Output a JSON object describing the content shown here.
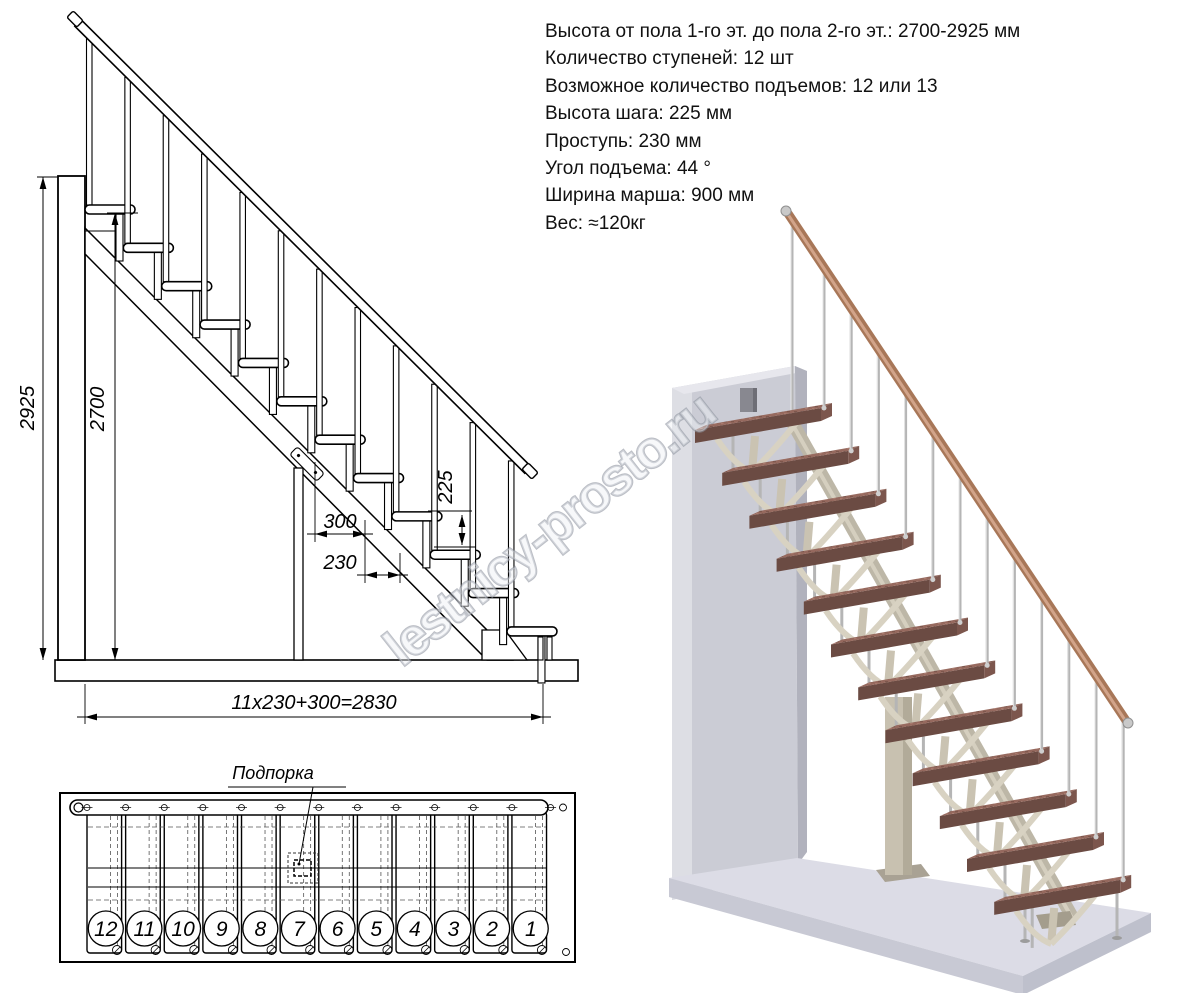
{
  "specs": {
    "lines": [
      "Высота от пола 1-го эт. до пола 2-го эт.: 2700-2925 мм",
      "Количество ступеней: 12 шт",
      "Возможное количество подъемов: 12 или 13",
      "Высота шага: 225 мм",
      "Проступь: 230 мм",
      "Угол подъема: 44 °",
      "Ширина марша: 900 мм",
      "Вес: ≈120кг"
    ]
  },
  "elevation": {
    "step_count": 12,
    "dims": {
      "total_height": "2925",
      "floor_height": "2700",
      "tread_depth": "300",
      "going": "230",
      "rise": "225",
      "length_formula": "11x230+300=2830"
    }
  },
  "plan": {
    "support_label": "Подпорка",
    "step_numbers": [
      "12",
      "11",
      "10",
      "9",
      "8",
      "7",
      "6",
      "5",
      "4",
      "3",
      "2",
      "1"
    ]
  },
  "watermark": {
    "text": "lestnicy-prosto.ru"
  },
  "colors": {
    "tread_top": "#96695e",
    "tread_front": "#6b4b43",
    "tread_side": "#7c564d",
    "handrail": "#a87758",
    "handrail_hl": "#d2a48a",
    "wall": "#cbccd5",
    "floor_top": "#dcdce6",
    "floor_front": "#c8c9d4",
    "metal": "#b5b5b5",
    "frame": "#c8c1b0",
    "bracket": "#d8d2c2",
    "line": "#000000"
  }
}
